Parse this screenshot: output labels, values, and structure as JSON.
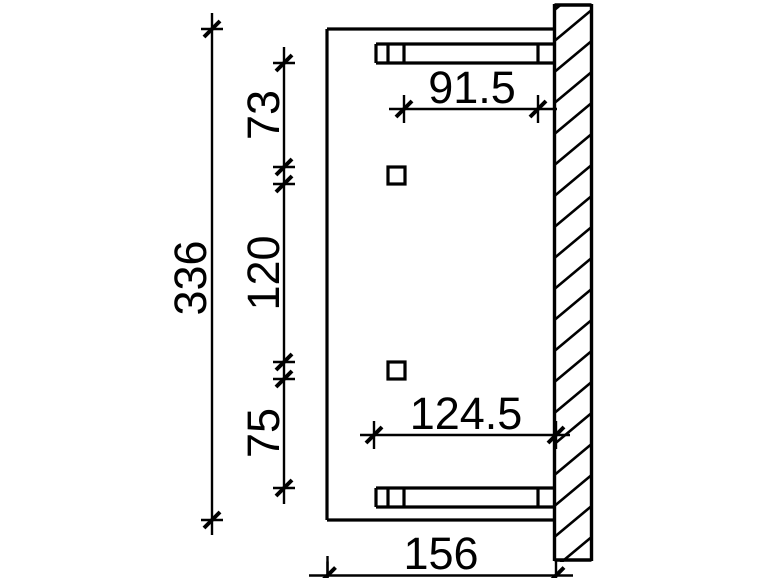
{
  "canvas": {
    "background": "#ffffff",
    "ink": "#000000"
  },
  "drawing": {
    "kind": "dimensioned technical plan of a wall-mounted canopy",
    "wall_hatch_style": "diagonal",
    "dimensions": [
      {
        "id": "total-height",
        "value": "336",
        "orientation": "vertical"
      },
      {
        "id": "segment-top",
        "value": "73",
        "orientation": "vertical"
      },
      {
        "id": "segment-middle",
        "value": "120",
        "orientation": "vertical"
      },
      {
        "id": "segment-bottom",
        "value": "75",
        "orientation": "vertical"
      },
      {
        "id": "upper-span",
        "value": "91.5",
        "orientation": "horizontal"
      },
      {
        "id": "lower-span",
        "value": "124.5",
        "orientation": "horizontal"
      },
      {
        "id": "depth",
        "value": "156",
        "orientation": "horizontal"
      }
    ]
  }
}
